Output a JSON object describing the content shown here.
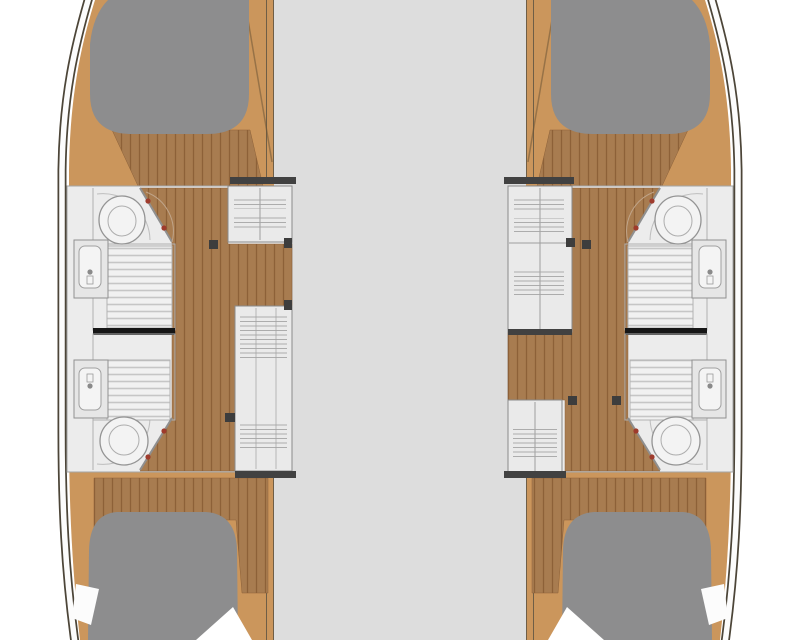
{
  "diagram": {
    "kind": "catamaran-deck-floor-plan",
    "view": "top-down",
    "hulls": [
      {
        "side": "left",
        "cabins": 2,
        "bathrooms": 2,
        "double_berths": 2,
        "bow_cushion": true,
        "stern_cushion": true,
        "wardrobes": 2
      },
      {
        "side": "right",
        "cabins": 2,
        "bathrooms": 2,
        "double_berths": 2,
        "bow_cushion": true,
        "stern_cushion": true,
        "wardrobes": 2
      }
    ],
    "bridge_deck": {
      "present": true
    }
  },
  "colors": {
    "background": "#ffffff",
    "bridge_deck": "#dddddd",
    "teak_deck": "#cb965c",
    "wood_floor": "#a87c50",
    "wood_plank_line": "#8d6138",
    "cushion_gray": "#8d8d8e",
    "cabin_floor": "#ececec",
    "cabinet_fill": "#eaeaea",
    "mattress": "#f1f1f1",
    "mattress_stripe": "#c6c6c6",
    "hull_outline": "#4c4538",
    "hull_band": "#fcfcfc",
    "gunwale_line": "#6f5e46",
    "bulkhead_black": "#161616",
    "wall_bar": "#414141",
    "furniture_line": "#8a8a8a",
    "door_accent_red": "#9e3b2c"
  }
}
